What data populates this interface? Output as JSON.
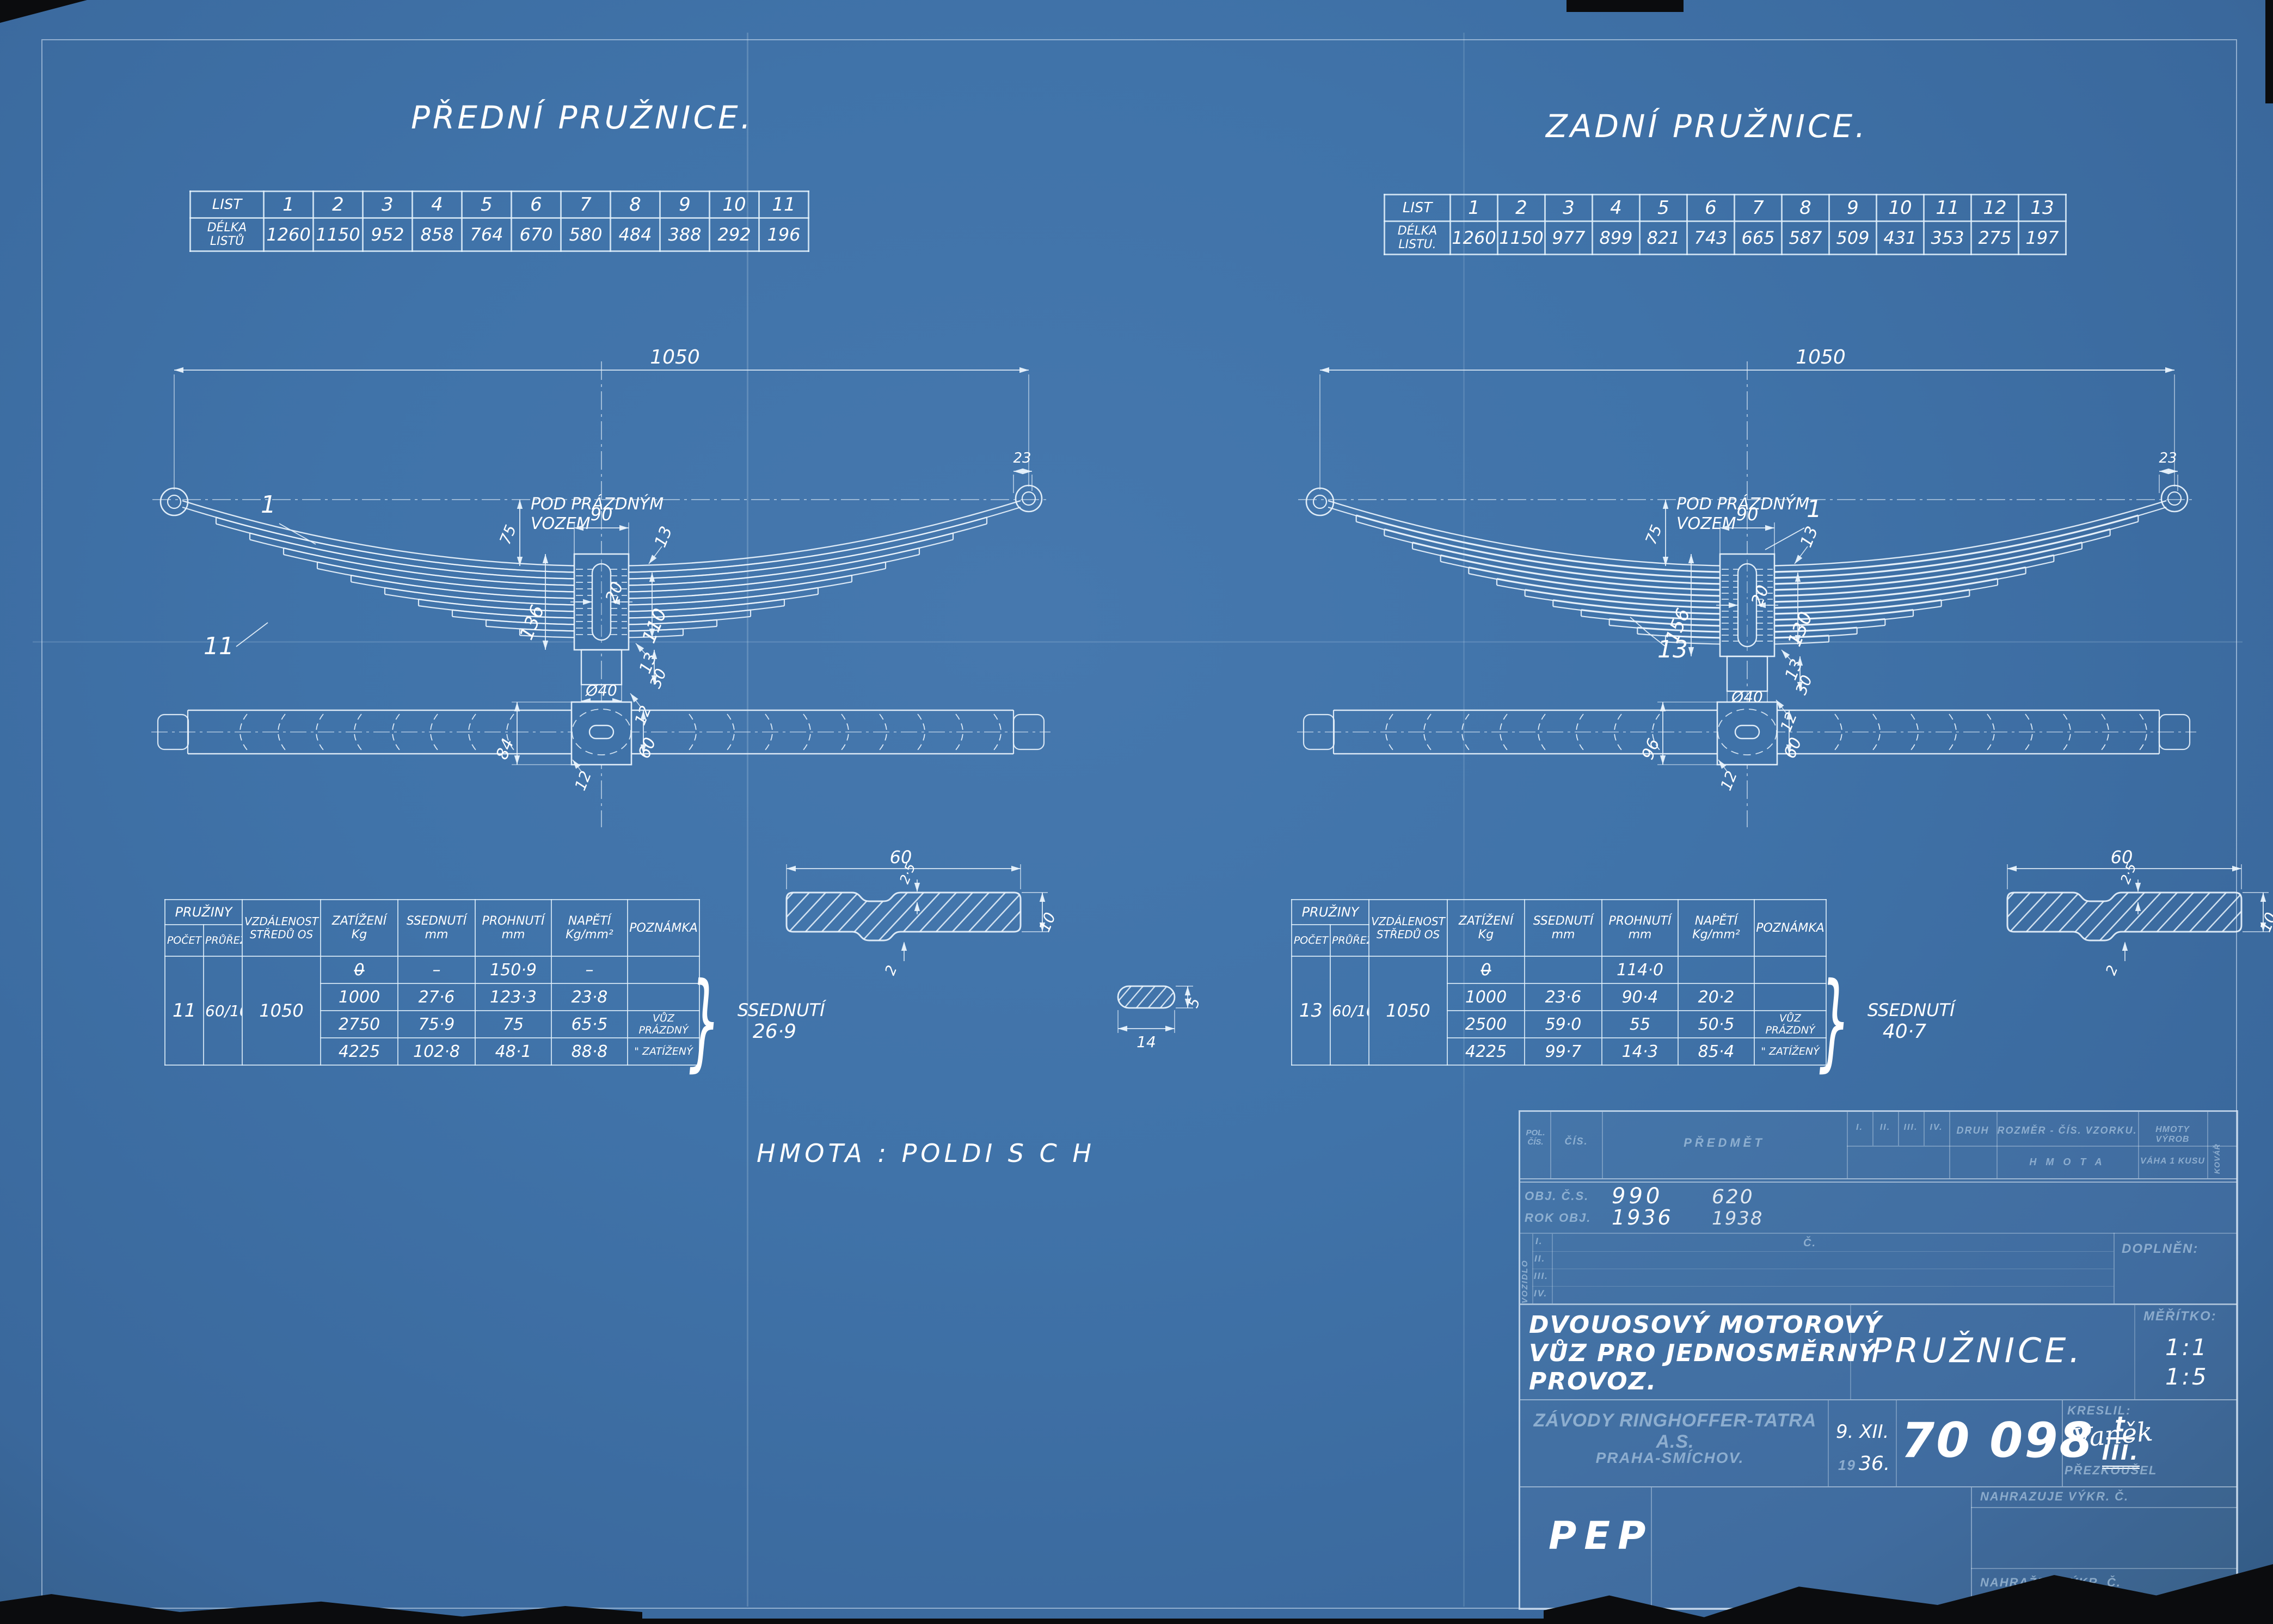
{
  "colors": {
    "bg": "#3f72a8",
    "line": "#e9f3fc"
  },
  "hmota": "HMOTA :  POLDI  S C H",
  "spec_headers": {
    "group": "PRUŽINY",
    "pocet": "POČET",
    "prurez": "PRŮŘEZ",
    "vzdalenost": "VZDÁLENOST\nSTŘEDŮ OS",
    "zatizeni": "ZATÍŽENÍ\nKg",
    "ssednuti": "SSEDNUTÍ\nmm",
    "prohnuti": "PROHNUTÍ\nmm",
    "napeti": "NAPĚTÍ\nKg/mm²",
    "poznamka": "POZNÁMKA"
  },
  "section": {
    "width": "60",
    "depth": "2·5",
    "thick": "10",
    "rib": "2"
  },
  "small_section": {
    "width": "14",
    "thick": "5"
  },
  "front": {
    "title": "PŘEDNÍ PRUŽNICE.",
    "leaf_table": {
      "row1_label": "LIST",
      "row2_label": "DÉLKA\nLISTŮ",
      "numbers": [
        "1",
        "2",
        "3",
        "4",
        "5",
        "6",
        "7",
        "8",
        "9",
        "10",
        "11"
      ],
      "lengths": [
        "1260",
        "1150",
        "952",
        "858",
        "764",
        "670",
        "580",
        "484",
        "388",
        "292",
        "196"
      ]
    },
    "drawing": {
      "span": "1050",
      "eye": "23",
      "leaf1": "1",
      "count": "11",
      "camber": "75",
      "note1": "POD PRÁZDNÝM",
      "note2": "VOZEM",
      "clamp": "90",
      "step_top": "13",
      "stack": "136",
      "free": "110",
      "bolt": "20",
      "step_bot": "13",
      "lower": "30",
      "dia": "Ø40",
      "pin": "12",
      "plan_w": "84",
      "plan_band": "60",
      "plan_pin": "12",
      "leaves": 11,
      "mirror": false
    },
    "spec": {
      "pocet": "11",
      "prurez": "60/10",
      "vzdalenost": "1050",
      "rows": [
        {
          "zatizeni": "0",
          "struck": true,
          "ssednuti": "–",
          "prohnuti": "150·9",
          "napeti": "–",
          "poznamka": ""
        },
        {
          "zatizeni": "1000",
          "struck": false,
          "ssednuti": "27·6",
          "prohnuti": "123·3",
          "napeti": "23·8",
          "poznamka": ""
        },
        {
          "zatizeni": "2750",
          "struck": false,
          "ssednuti": "75·9",
          "prohnuti": "75",
          "napeti": "65·5",
          "poznamka": "VŮZ PRÁZDNÝ"
        },
        {
          "zatizeni": "4225",
          "struck": false,
          "ssednuti": "102·8",
          "prohnuti": "48·1",
          "napeti": "88·8",
          "poznamka": "\" ZATÍŽENÝ"
        }
      ]
    },
    "note": {
      "label": "SSEDNUTÍ",
      "value": "26·9"
    }
  },
  "rear": {
    "title": "ZADNÍ PRUŽNICE.",
    "leaf_table": {
      "row1_label": "LIST",
      "row2_label": "DÉLKA\nLISTU.",
      "numbers": [
        "1",
        "2",
        "3",
        "4",
        "5",
        "6",
        "7",
        "8",
        "9",
        "10",
        "11",
        "12",
        "13"
      ],
      "lengths": [
        "1260",
        "1150",
        "977",
        "899",
        "821",
        "743",
        "665",
        "587",
        "509",
        "431",
        "353",
        "275",
        "197"
      ]
    },
    "drawing": {
      "span": "1050",
      "eye": "23",
      "leaf1": "1",
      "count": "13",
      "camber": "75",
      "note1": "POD PRÁZDNÝM",
      "note2": "VOZEM",
      "clamp": "90",
      "step_top": "13",
      "stack": "156",
      "free": "130",
      "bolt": "20",
      "step_bot": "13",
      "lower": "30",
      "dia": "Ø40",
      "pin": "12",
      "plan_w": "96",
      "plan_band": "60",
      "plan_pin": "12",
      "leaves": 13,
      "mirror": true
    },
    "spec": {
      "pocet": "13",
      "prurez": "60/10",
      "vzdalenost": "1050",
      "rows": [
        {
          "zatizeni": "0",
          "struck": true,
          "ssednuti": "",
          "prohnuti": "114·0",
          "napeti": "",
          "poznamka": ""
        },
        {
          "zatizeni": "1000",
          "struck": false,
          "ssednuti": "23·6",
          "prohnuti": "90·4",
          "napeti": "20·2",
          "poznamka": ""
        },
        {
          "zatizeni": "2500",
          "struck": false,
          "ssednuti": "59·0",
          "prohnuti": "55",
          "napeti": "50·5",
          "poznamka": "VŮZ PRÁZDNÝ"
        },
        {
          "zatizeni": "4225",
          "struck": false,
          "ssednuti": "99·7",
          "prohnuti": "14·3",
          "napeti": "85·4",
          "poznamka": "\" ZATÍŽENÝ"
        }
      ]
    },
    "note": {
      "label": "SSEDNUTÍ",
      "value": "40·7"
    }
  },
  "title_block": {
    "header": {
      "pol": "POL. ČÍS.",
      "cis": "ČÍS.",
      "predmet": "PŘEDMĚT",
      "romans": [
        "I.",
        "II.",
        "III.",
        "IV."
      ],
      "druh": "DRUH",
      "rozmer": "ROZMĚR - ČÍS. VZORKU.",
      "hmota": "H M O T A",
      "vyrob": "HMOTY VÝROB",
      "vaha": "VÁHA 1 KUSU",
      "kovar": "KOVÁŘ"
    },
    "obj": {
      "label": "OBJ. Č.S.",
      "v1": "990",
      "v2": "620"
    },
    "rok": {
      "label": "ROK OBJ.",
      "v1": "1936",
      "v2": "1938"
    },
    "vozidlo": "VOZIDLO",
    "rows": [
      "I.",
      "II.",
      "III.",
      "IV."
    ],
    "c_label": "Č.",
    "doplnen": "DOPLNĚN:",
    "subject": [
      "DVOUOSOVÝ MOTOROVÝ",
      "VŮZ PRO JEDNOSMĚRNÝ",
      "PROVOZ."
    ],
    "part": "PRUŽNICE.",
    "meritko_label": "MĚŘÍTKO:",
    "scales": [
      "1:1",
      "1:5"
    ],
    "company": "ZÁVODY RINGHOFFER-TATRA A.S.",
    "city": "PRAHA-SMÍCHOV.",
    "date_line1": "9.  XII.",
    "date_prefix": "19",
    "date_year": "36.",
    "number": "70 098",
    "num_top": "t",
    "num_bottom": "III.",
    "kreslil": "KRESLIL:",
    "drawn": "Vaněk",
    "prezkousel": "PŘEZKOUŠEL",
    "nahrazuje": "NAHRAZUJE VÝKR. Č.",
    "nahrazen": "NAHRAŽEN VÝKR. Č.",
    "pep": "PEP"
  }
}
